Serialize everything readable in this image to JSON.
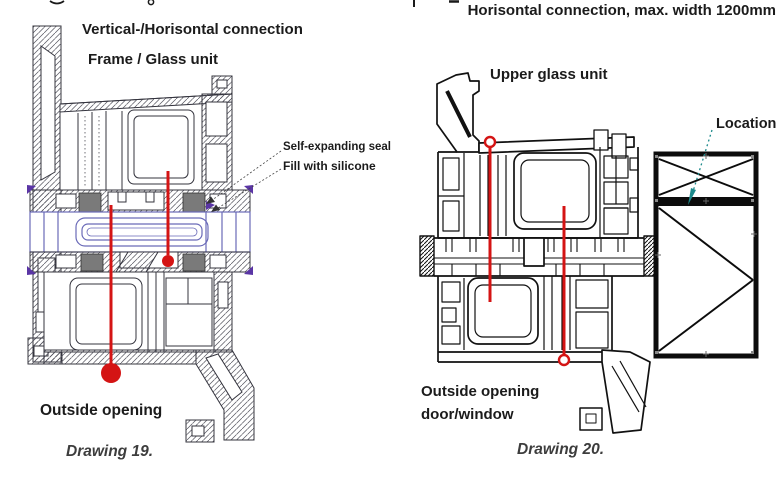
{
  "header": {
    "right_title": "Horisontal connection, max. width 1200mm"
  },
  "drawing19": {
    "title_line1": "Vertical-/Horisontal connection",
    "title_line2": "Frame / Glass unit",
    "label_seal": "Self-expanding seal",
    "label_silicone": "Fill with silicone",
    "label_outside_opening": "Outside opening",
    "caption": "Drawing 19."
  },
  "drawing20": {
    "label_upper_glass": "Upper glass unit",
    "label_outside_line1": "Outside opening",
    "label_outside_line2": "door/window",
    "caption": "Drawing 20."
  },
  "location": {
    "label": "Location"
  },
  "colors": {
    "red": "#d41414",
    "seal": "#7a7a7a",
    "ink19": "#34343e",
    "ink20": "#111111",
    "glass": "#6a6ab8",
    "accent": "#5a35a5",
    "teal": "#1d8a8c",
    "text": "#1b1b1b",
    "caption": "#3d3d3d",
    "hatch": "#54545e"
  }
}
